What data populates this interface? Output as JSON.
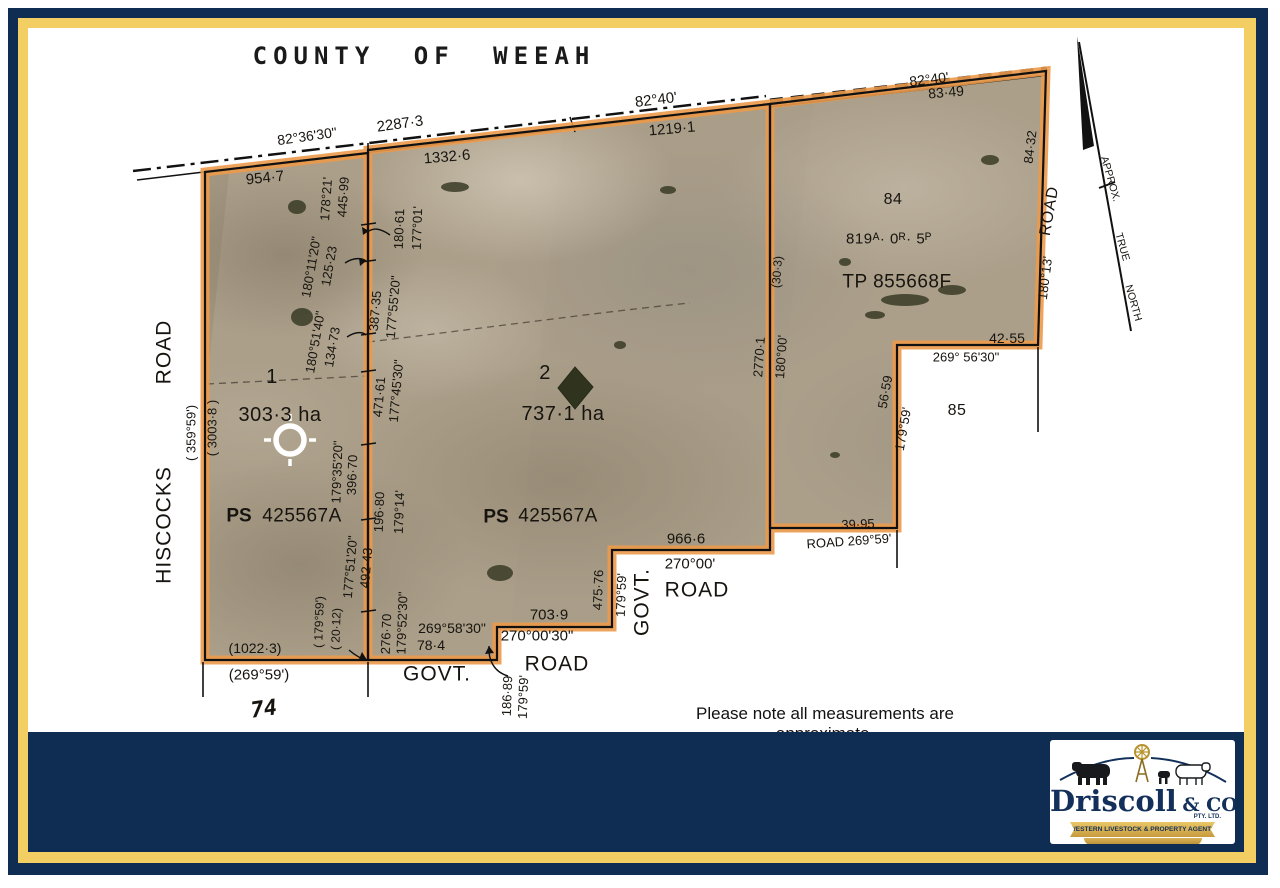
{
  "colors": {
    "navy": "#0F2D52",
    "gold": "#F2CE63",
    "orange": "#EC9A4A",
    "photo_base": "#AB9F8A"
  },
  "title": "COUNTY OF WEEAH",
  "note": "Please note all measurements are approximate.",
  "logo": {
    "name": "Driscoll",
    "suffix": "& CO.",
    "pty": "PTY. LTD.",
    "banner": "WESTERN LIVESTOCK & PROPERTY AGENTS"
  },
  "north_arrow": {
    "labels": [
      "APPROX.",
      "TRUE",
      "NORTH"
    ]
  },
  "map_labels": [
    {
      "t": "COUNTY OF WEEAH",
      "x": 424,
      "y": 56,
      "fs": 24,
      "cls": "title"
    },
    {
      "t": "82°36'30\"",
      "x": 307,
      "y": 136,
      "r": -8,
      "fs": 14
    },
    {
      "t": "2287·3",
      "x": 400,
      "y": 124,
      "r": -8,
      "fs": 15
    },
    {
      "t": "82°40'",
      "x": 656,
      "y": 100,
      "r": -7,
      "fs": 15
    },
    {
      "t": "1219·1",
      "x": 672,
      "y": 129,
      "r": -5,
      "fs": 15
    },
    {
      "t": "1332·6",
      "x": 447,
      "y": 157,
      "r": -5,
      "fs": 15
    },
    {
      "t": "954·7",
      "x": 265,
      "y": 178,
      "r": -6,
      "fs": 15
    },
    {
      "t": "82°40'",
      "x": 929,
      "y": 79,
      "r": -7,
      "fs": 14
    },
    {
      "t": "83·49",
      "x": 946,
      "y": 92,
      "r": -5,
      "fs": 14
    },
    {
      "t": "ROAD",
      "x": 164,
      "y": 352,
      "r": -90,
      "fs": 21,
      "cls": "road"
    },
    {
      "t": "HISCOCKS",
      "x": 164,
      "y": 525,
      "r": -90,
      "fs": 21,
      "cls": "road"
    },
    {
      "t": "( 359°59')",
      "x": 191,
      "y": 433,
      "r": -90,
      "fs": 13
    },
    {
      "t": "( 3003·8 )",
      "x": 212,
      "y": 428,
      "r": -90,
      "fs": 13
    },
    {
      "t": "178°21'",
      "x": 326,
      "y": 199,
      "r": -86,
      "fs": 13
    },
    {
      "t": "445·99",
      "x": 343,
      "y": 197,
      "r": -86,
      "fs": 13
    },
    {
      "t": "180°11'20\"",
      "x": 311,
      "y": 267,
      "r": -80,
      "fs": 13
    },
    {
      "t": "125·23",
      "x": 329,
      "y": 266,
      "r": -80,
      "fs": 13
    },
    {
      "t": "180°51'40\"",
      "x": 315,
      "y": 342,
      "r": -80,
      "fs": 13
    },
    {
      "t": "134·73",
      "x": 332,
      "y": 347,
      "r": -80,
      "fs": 13
    },
    {
      "t": "179°35'20\"",
      "x": 337,
      "y": 472,
      "r": -88,
      "fs": 13
    },
    {
      "t": "396·70",
      "x": 352,
      "y": 475,
      "r": -88,
      "fs": 13
    },
    {
      "t": "177°51'20\"",
      "x": 350,
      "y": 567,
      "r": -85,
      "fs": 13
    },
    {
      "t": "492·43",
      "x": 366,
      "y": 568,
      "r": -85,
      "fs": 13
    },
    {
      "t": "( 179°59')",
      "x": 319,
      "y": 622,
      "r": -88,
      "fs": 12
    },
    {
      "t": "( 20·12)",
      "x": 336,
      "y": 629,
      "r": -88,
      "fs": 12
    },
    {
      "t": "(1022·3)",
      "x": 255,
      "y": 648,
      "fs": 14
    },
    {
      "t": "(269°59')",
      "x": 259,
      "y": 675,
      "fs": 15
    },
    {
      "t": "74",
      "x": 264,
      "y": 710,
      "r": -8,
      "fs": 22,
      "cls": "dotted"
    },
    {
      "t": "1",
      "x": 272,
      "y": 377,
      "fs": 20,
      "cls": "lot"
    },
    {
      "t": "303·3 ha",
      "x": 280,
      "y": 415,
      "fs": 20,
      "cls": "lot"
    },
    {
      "t": "PS",
      "x": 239,
      "y": 516,
      "fs": 19,
      "cls": "ps"
    },
    {
      "t": "425567A",
      "x": 302,
      "y": 516,
      "fs": 19,
      "cls": "lot"
    },
    {
      "t": "180·61",
      "x": 399,
      "y": 229,
      "r": -88,
      "fs": 13
    },
    {
      "t": "177°01'",
      "x": 417,
      "y": 228,
      "r": -88,
      "fs": 13
    },
    {
      "t": "387·35",
      "x": 375,
      "y": 311,
      "r": -85,
      "fs": 13
    },
    {
      "t": "177°55'20\"",
      "x": 393,
      "y": 307,
      "r": -85,
      "fs": 13
    },
    {
      "t": "471·61",
      "x": 379,
      "y": 397,
      "r": -85,
      "fs": 13
    },
    {
      "t": "177°45'30\"",
      "x": 396,
      "y": 391,
      "r": -85,
      "fs": 13
    },
    {
      "t": "196·80",
      "x": 379,
      "y": 512,
      "r": -88,
      "fs": 13
    },
    {
      "t": "179°14'",
      "x": 399,
      "y": 512,
      "r": -88,
      "fs": 13
    },
    {
      "t": "276·70",
      "x": 386,
      "y": 634,
      "r": -88,
      "fs": 13
    },
    {
      "t": "179°52'30\"",
      "x": 402,
      "y": 623,
      "r": -88,
      "fs": 13
    },
    {
      "t": "2",
      "x": 545,
      "y": 373,
      "fs": 20,
      "cls": "lot"
    },
    {
      "t": "737·1 ha",
      "x": 563,
      "y": 414,
      "fs": 20,
      "cls": "lot"
    },
    {
      "t": "PS",
      "x": 496,
      "y": 517,
      "fs": 19,
      "cls": "ps"
    },
    {
      "t": "425567A",
      "x": 558,
      "y": 516,
      "fs": 19,
      "cls": "lot"
    },
    {
      "t": "703·9",
      "x": 549,
      "y": 615,
      "fs": 15
    },
    {
      "t": "269°58'30\"",
      "x": 452,
      "y": 628,
      "fs": 14
    },
    {
      "t": "78·4",
      "x": 431,
      "y": 645,
      "fs": 14
    },
    {
      "t": "270°00'30\"",
      "x": 537,
      "y": 636,
      "fs": 15
    },
    {
      "t": "ROAD",
      "x": 557,
      "y": 664,
      "fs": 21,
      "cls": "road"
    },
    {
      "t": "GOVT.",
      "x": 437,
      "y": 674,
      "fs": 21,
      "cls": "road"
    },
    {
      "t": "186·89",
      "x": 507,
      "y": 696,
      "r": -88,
      "fs": 13
    },
    {
      "t": "179°59'",
      "x": 523,
      "y": 697,
      "r": -88,
      "fs": 13
    },
    {
      "t": "475·76",
      "x": 598,
      "y": 590,
      "r": -88,
      "fs": 13
    },
    {
      "t": "179°59'",
      "x": 621,
      "y": 595,
      "r": -88,
      "fs": 13
    },
    {
      "t": "GOVT.",
      "x": 642,
      "y": 602,
      "r": -90,
      "fs": 21,
      "cls": "road"
    },
    {
      "t": "966·6",
      "x": 686,
      "y": 539,
      "fs": 15
    },
    {
      "t": "270°00'",
      "x": 690,
      "y": 564,
      "fs": 15
    },
    {
      "t": "ROAD",
      "x": 697,
      "y": 590,
      "fs": 21,
      "cls": "road"
    },
    {
      "t": "2770·1",
      "x": 759,
      "y": 357,
      "r": -86,
      "fs": 13
    },
    {
      "t": "180°00'",
      "x": 781,
      "y": 357,
      "r": -86,
      "fs": 13
    },
    {
      "t": "(30·3)",
      "x": 777,
      "y": 272,
      "r": -86,
      "fs": 12
    },
    {
      "t": "84",
      "x": 893,
      "y": 200,
      "fs": 16,
      "cls": "lot"
    },
    {
      "t": "819ᴬ· 0ᴿ· 5ᴾ",
      "x": 889,
      "y": 239,
      "fs": 15,
      "cls": "lot"
    },
    {
      "t": "TP 855668F",
      "x": 897,
      "y": 282,
      "fs": 19,
      "cls": "lot"
    },
    {
      "t": "84·32",
      "x": 1030,
      "y": 147,
      "r": -83,
      "fs": 13
    },
    {
      "t": "ROAD",
      "x": 1050,
      "y": 211,
      "r": -80,
      "fs": 16,
      "cls": "road"
    },
    {
      "t": "180°13'",
      "x": 1045,
      "y": 278,
      "r": -83,
      "fs": 13
    },
    {
      "t": "42·55",
      "x": 1007,
      "y": 338,
      "fs": 14
    },
    {
      "t": "269° 56'30\"",
      "x": 966,
      "y": 357,
      "fs": 13
    },
    {
      "t": "56·59",
      "x": 885,
      "y": 392,
      "r": -80,
      "fs": 13
    },
    {
      "t": "179°59'",
      "x": 903,
      "y": 429,
      "r": -80,
      "fs": 13
    },
    {
      "t": "85",
      "x": 957,
      "y": 411,
      "fs": 16,
      "cls": "lot"
    },
    {
      "t": "39·95",
      "x": 858,
      "y": 524,
      "r": -2,
      "fs": 13
    },
    {
      "t": "ROAD 269°59'",
      "x": 849,
      "y": 541,
      "r": -4,
      "fs": 13
    },
    {
      "t": "APPROX.",
      "x": 1110,
      "y": 179,
      "r": 74,
      "fs": 10.5
    },
    {
      "t": "TRUE",
      "x": 1122,
      "y": 247,
      "r": 74,
      "fs": 10.5
    },
    {
      "t": "NORTH",
      "x": 1133,
      "y": 303,
      "r": 74,
      "fs": 10.5
    }
  ]
}
